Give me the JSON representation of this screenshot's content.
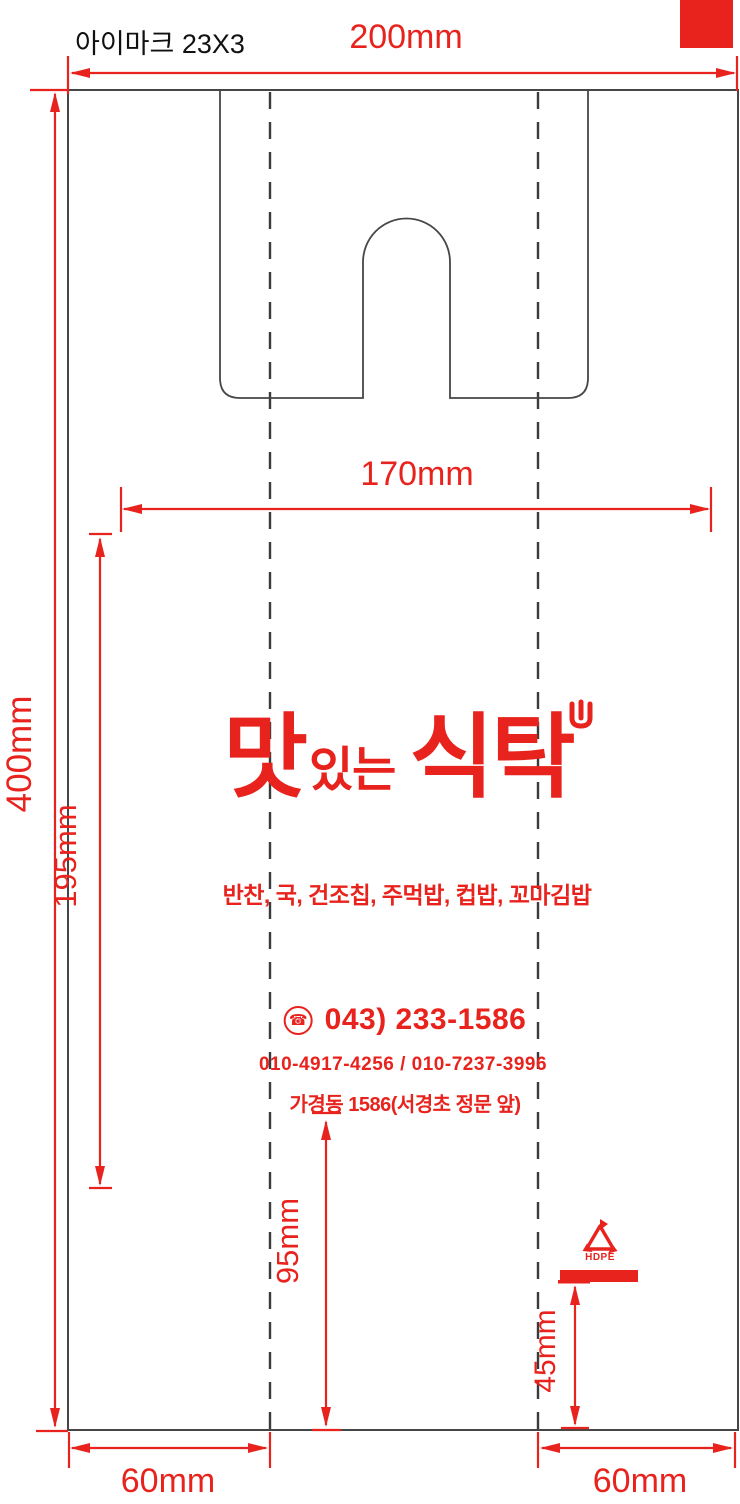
{
  "annotations": {
    "plate_note": "아이마크 23X3",
    "dim_width": "200mm",
    "dim_height": "400mm",
    "dim_inner_width": "170mm",
    "dim_print_height": "195mm",
    "dim_address_to_bottom": "95mm",
    "dim_bar_to_bottom": "45mm",
    "dim_gusset_left": "60mm",
    "dim_gusset_right": "60mm"
  },
  "artwork": {
    "logo_part1": "맛",
    "logo_part2": "있는",
    "logo_part3": "식탁",
    "menu_line": "반찬, 국, 건조칩, 주먹밥, 컵밥, 꼬마김밥",
    "phone_icon_glyph": "☎",
    "phone_main": "043) 233-1586",
    "phone_mobile": "010-4917-4256 / 010-7237-3996",
    "address": "가경동 1586(서경초 정문 앞)",
    "recycle_material": "HDPE"
  },
  "colors": {
    "accent_red": "#e8231e",
    "outline_gray": "#464646",
    "dash_gray": "#3b3b3b",
    "text_black": "#111111"
  }
}
